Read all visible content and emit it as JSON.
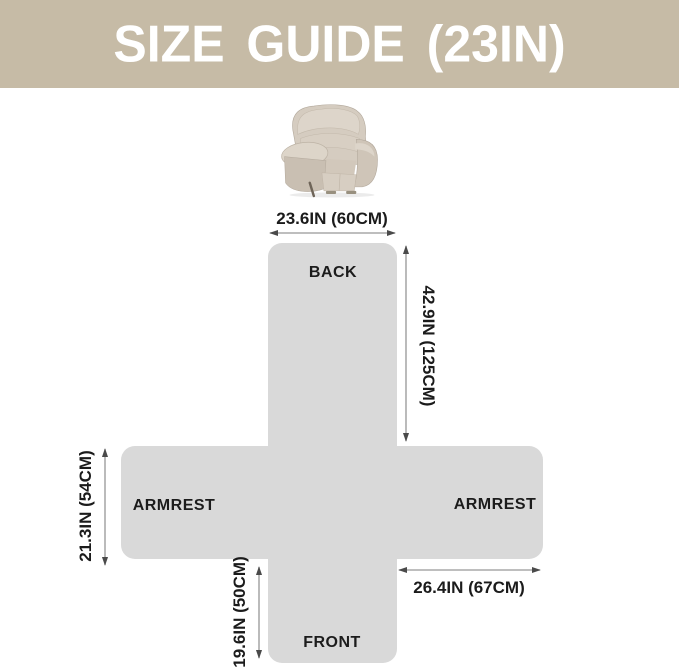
{
  "header": {
    "title": "SIZE GUIDE (23IN)"
  },
  "chair": {
    "alt": "recliner-chair"
  },
  "diagram": {
    "panels": {
      "back": "BACK",
      "armrest_left": "ARMREST",
      "armrest_right": "ARMREST",
      "front": "FRONT"
    },
    "measurements": {
      "back_width": "23.6IN (60CM)",
      "back_length": "42.9IN (125CM)",
      "armrest_width": "21.3IN (54CM)",
      "armrest_length": "26.4IN (67CM)",
      "front_length": "19.6IN (50CM)"
    },
    "colors": {
      "banner": "#c6bba6",
      "panel_fill": "#d9d9d9",
      "label_text": "#1c1c1c",
      "measure_line": "#969696"
    }
  }
}
